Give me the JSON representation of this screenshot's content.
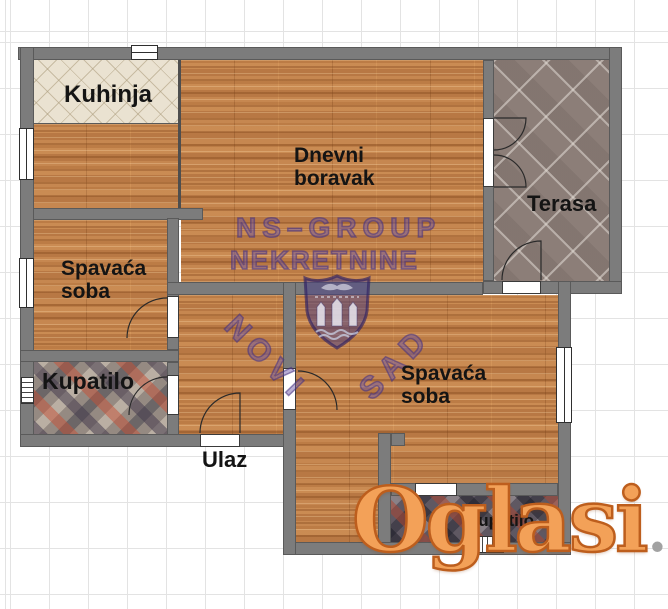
{
  "floorplan": {
    "rooms": {
      "kitchen": {
        "label": "Kuhinja"
      },
      "living": {
        "line1": "Dnevni",
        "line2": "boravak"
      },
      "terrace": {
        "label": "Terasa"
      },
      "bedroom_left": {
        "line1": "Spavaća",
        "line2": "soba"
      },
      "bathroom_left": {
        "label": "Kupatilo"
      },
      "entrance": {
        "label": "Ulaz"
      },
      "bedroom_right": {
        "line1": "Spavaća",
        "line2": "soba"
      },
      "bathroom_right": {
        "label": "Kupatilo"
      }
    },
    "watermark": {
      "line1": "NS–GROUP",
      "line2": "NEKRETNINE",
      "city_left": "NOVI",
      "city_right": "SAD",
      "emblem": "novi-sad-coat-of-arms"
    },
    "logo": {
      "word": "Oglasi",
      "tld": ".rs"
    },
    "colors": {
      "wall": "#7c7c7c",
      "wood": "#c4854f",
      "kitchen_tile": "#eae2d1",
      "terrace_tile": "#8c7e78",
      "bath_left_tile": "#958a82",
      "bath_right_tile": "#5f5862",
      "watermark_purple": "#5a4490",
      "logo_orange": "#f3a158",
      "logo_gray": "#a2a2a2",
      "grid_line": "#e3e3e3"
    }
  }
}
